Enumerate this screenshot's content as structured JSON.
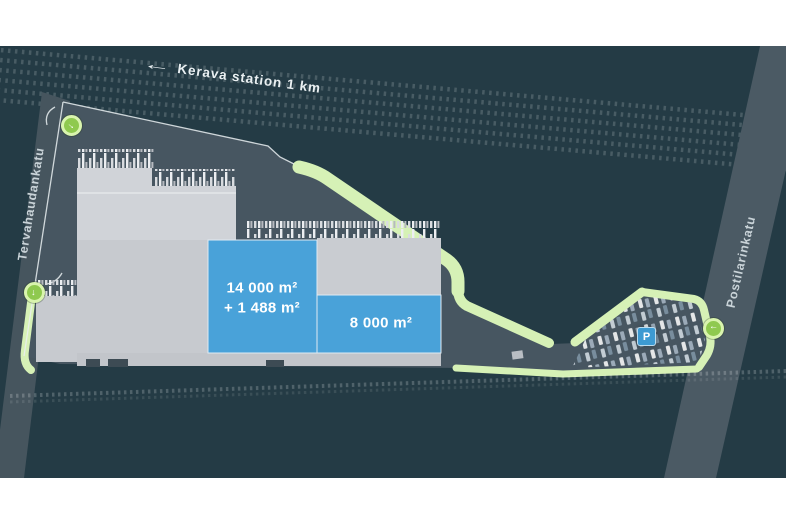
{
  "map": {
    "colors": {
      "background": "#243b45",
      "site_surface": "#475661",
      "road": "#4b5a64",
      "building_gray": "#c9ccd1",
      "unit_highlight_blue": "#49a2d9",
      "boundary_green": "#d6f1b6",
      "entrance_marker_green": "#8fc94f",
      "parking_sign_blue": "#3d9ad2"
    },
    "railway_label": {
      "arrow": "←",
      "text": "Kerava station 1 km"
    },
    "streets": {
      "left": "Tervahaudankatu",
      "right": "Postilarinkatu"
    },
    "units": [
      {
        "id": "unit-1",
        "line1": "14 000 m²",
        "line2": "+ 1 488 m²"
      },
      {
        "id": "unit-2",
        "line1": "8 000 m²"
      }
    ],
    "parking": {
      "symbol": "P"
    },
    "entrances": [
      {
        "id": "gate-north",
        "glyph": "→"
      },
      {
        "id": "gate-west",
        "glyph": "→"
      },
      {
        "id": "gate-east",
        "glyph": "→"
      }
    ]
  }
}
